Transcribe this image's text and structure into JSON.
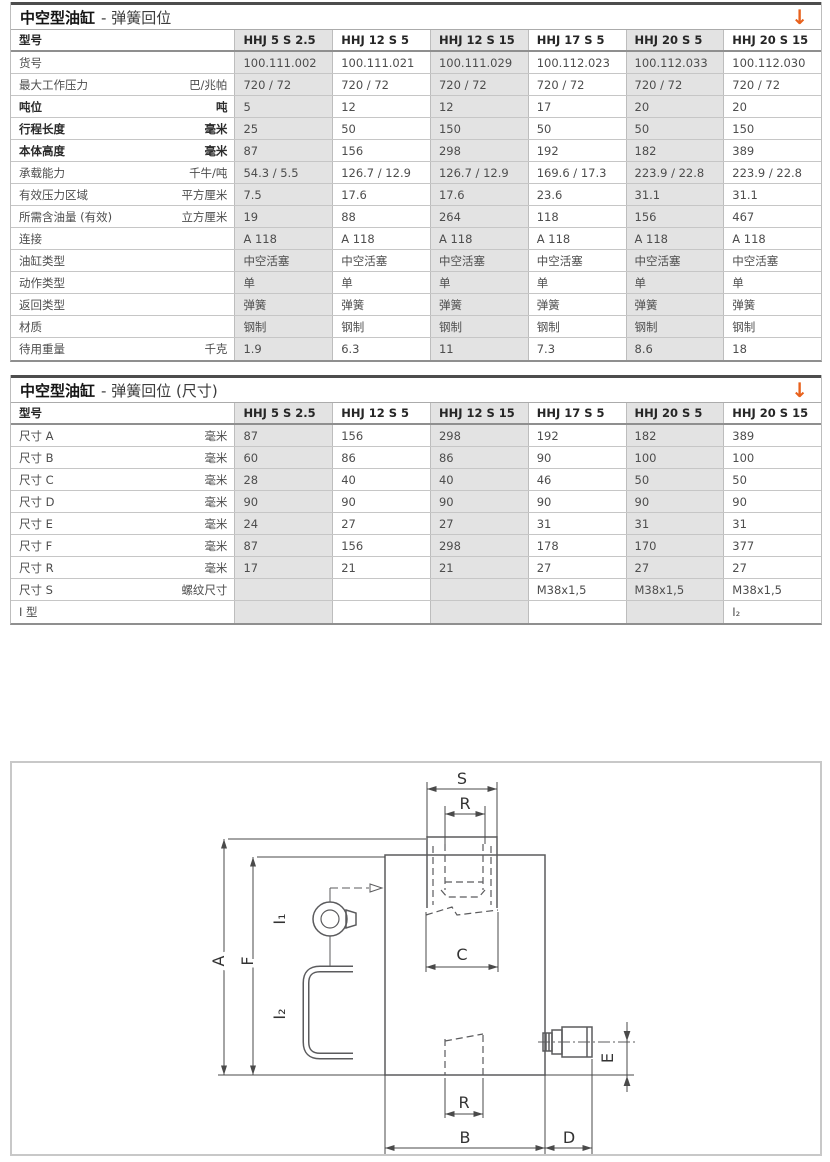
{
  "colors": {
    "accent_orange": "#e8611c",
    "column_shade": "#e3e3e3",
    "drawing_line": "#5b5b5d"
  },
  "table1": {
    "title_main": "中空型油缸",
    "title_sub": "- 弹簧回位",
    "arrow_icon": "↓",
    "header": [
      "型号",
      "HHJ 5 S 2.5",
      "HHJ 12 S 5",
      "HHJ 12 S 15",
      "HHJ 17 S 5",
      "HHJ 20 S 5",
      "HHJ 20 S 15"
    ],
    "rows": [
      {
        "label": "货号",
        "unit": "",
        "bold": false,
        "values": [
          "100.111.002",
          "100.111.021",
          "100.111.029",
          "100.112.023",
          "100.112.033",
          "100.112.030"
        ]
      },
      {
        "label": "最大工作压力",
        "unit": "巴/兆帕",
        "bold": false,
        "values": [
          "720 / 72",
          "720 / 72",
          "720 / 72",
          "720 / 72",
          "720 / 72",
          "720 / 72"
        ]
      },
      {
        "label": "吨位",
        "unit": "吨",
        "bold": true,
        "values": [
          "5",
          "12",
          "12",
          "17",
          "20",
          "20"
        ]
      },
      {
        "label": "行程长度",
        "unit": "毫米",
        "bold": true,
        "values": [
          "25",
          "50",
          "150",
          "50",
          "50",
          "150"
        ]
      },
      {
        "label": "本体高度",
        "unit": "毫米",
        "bold": true,
        "values": [
          "87",
          "156",
          "298",
          "192",
          "182",
          "389"
        ]
      },
      {
        "label": "承载能力",
        "unit": "千牛/吨",
        "bold": false,
        "values": [
          "54.3 / 5.5",
          "126.7 / 12.9",
          "126.7 / 12.9",
          "169.6 / 17.3",
          "223.9 / 22.8",
          "223.9 / 22.8"
        ]
      },
      {
        "label": "有效压力区域",
        "unit": "平方厘米",
        "bold": false,
        "values": [
          "7.5",
          "17.6",
          "17.6",
          "23.6",
          "31.1",
          "31.1"
        ]
      },
      {
        "label": "所需含油量 (有效)",
        "unit": "立方厘米",
        "bold": false,
        "values": [
          "19",
          "88",
          "264",
          "118",
          "156",
          "467"
        ]
      },
      {
        "label": "连接",
        "unit": "",
        "bold": false,
        "values": [
          "A 118",
          "A 118",
          "A 118",
          "A 118",
          "A 118",
          "A 118"
        ]
      },
      {
        "label": "油缸类型",
        "unit": "",
        "bold": false,
        "values": [
          "中空活塞",
          "中空活塞",
          "中空活塞",
          "中空活塞",
          "中空活塞",
          "中空活塞"
        ]
      },
      {
        "label": "动作类型",
        "unit": "",
        "bold": false,
        "values": [
          "单",
          "单",
          "单",
          "单",
          "单",
          "单"
        ]
      },
      {
        "label": "返回类型",
        "unit": "",
        "bold": false,
        "values": [
          "弹簧",
          "弹簧",
          "弹簧",
          "弹簧",
          "弹簧",
          "弹簧"
        ]
      },
      {
        "label": "材质",
        "unit": "",
        "bold": false,
        "values": [
          "钢制",
          "钢制",
          "钢制",
          "钢制",
          "钢制",
          "钢制"
        ]
      },
      {
        "label": "待用重量",
        "unit": "千克",
        "bold": false,
        "values": [
          "1.9",
          "6.3",
          "11",
          "7.3",
          "8.6",
          "18"
        ]
      }
    ]
  },
  "table2": {
    "title_main": "中空型油缸",
    "title_sub": "- 弹簧回位 (尺寸)",
    "arrow_icon": "↓",
    "header": [
      "型号",
      "HHJ 5 S 2.5",
      "HHJ 12 S 5",
      "HHJ 12 S 15",
      "HHJ 17 S 5",
      "HHJ 20 S 5",
      "HHJ 20 S 15"
    ],
    "rows": [
      {
        "label": "尺寸 A",
        "unit": "毫米",
        "bold": false,
        "values": [
          "87",
          "156",
          "298",
          "192",
          "182",
          "389"
        ]
      },
      {
        "label": "尺寸 B",
        "unit": "毫米",
        "bold": false,
        "values": [
          "60",
          "86",
          "86",
          "90",
          "100",
          "100"
        ]
      },
      {
        "label": "尺寸 C",
        "unit": "毫米",
        "bold": false,
        "values": [
          "28",
          "40",
          "40",
          "46",
          "50",
          "50"
        ]
      },
      {
        "label": "尺寸 D",
        "unit": "毫米",
        "bold": false,
        "values": [
          "90",
          "90",
          "90",
          "90",
          "90",
          "90"
        ]
      },
      {
        "label": "尺寸 E",
        "unit": "毫米",
        "bold": false,
        "values": [
          "24",
          "27",
          "27",
          "31",
          "31",
          "31"
        ]
      },
      {
        "label": "尺寸 F",
        "unit": "毫米",
        "bold": false,
        "values": [
          "87",
          "156",
          "298",
          "178",
          "170",
          "377"
        ]
      },
      {
        "label": "尺寸 R",
        "unit": "毫米",
        "bold": false,
        "values": [
          "17",
          "21",
          "21",
          "27",
          "27",
          "27"
        ]
      },
      {
        "label": "尺寸 S",
        "unit": "螺纹尺寸",
        "bold": false,
        "values": [
          "",
          "",
          "",
          "M38x1,5",
          "M38x1,5",
          "M38x1,5"
        ]
      },
      {
        "label": "I 型",
        "unit": "",
        "bold": false,
        "values": [
          "",
          "",
          "",
          "",
          "",
          "I₂"
        ]
      }
    ]
  },
  "diagram": {
    "labels": {
      "s": "S",
      "r_top": "R",
      "c": "C",
      "a": "A",
      "f": "F",
      "i1": "I₁",
      "i2": "I₂",
      "e": "E",
      "r_bottom": "R",
      "b": "B",
      "d": "D"
    }
  }
}
